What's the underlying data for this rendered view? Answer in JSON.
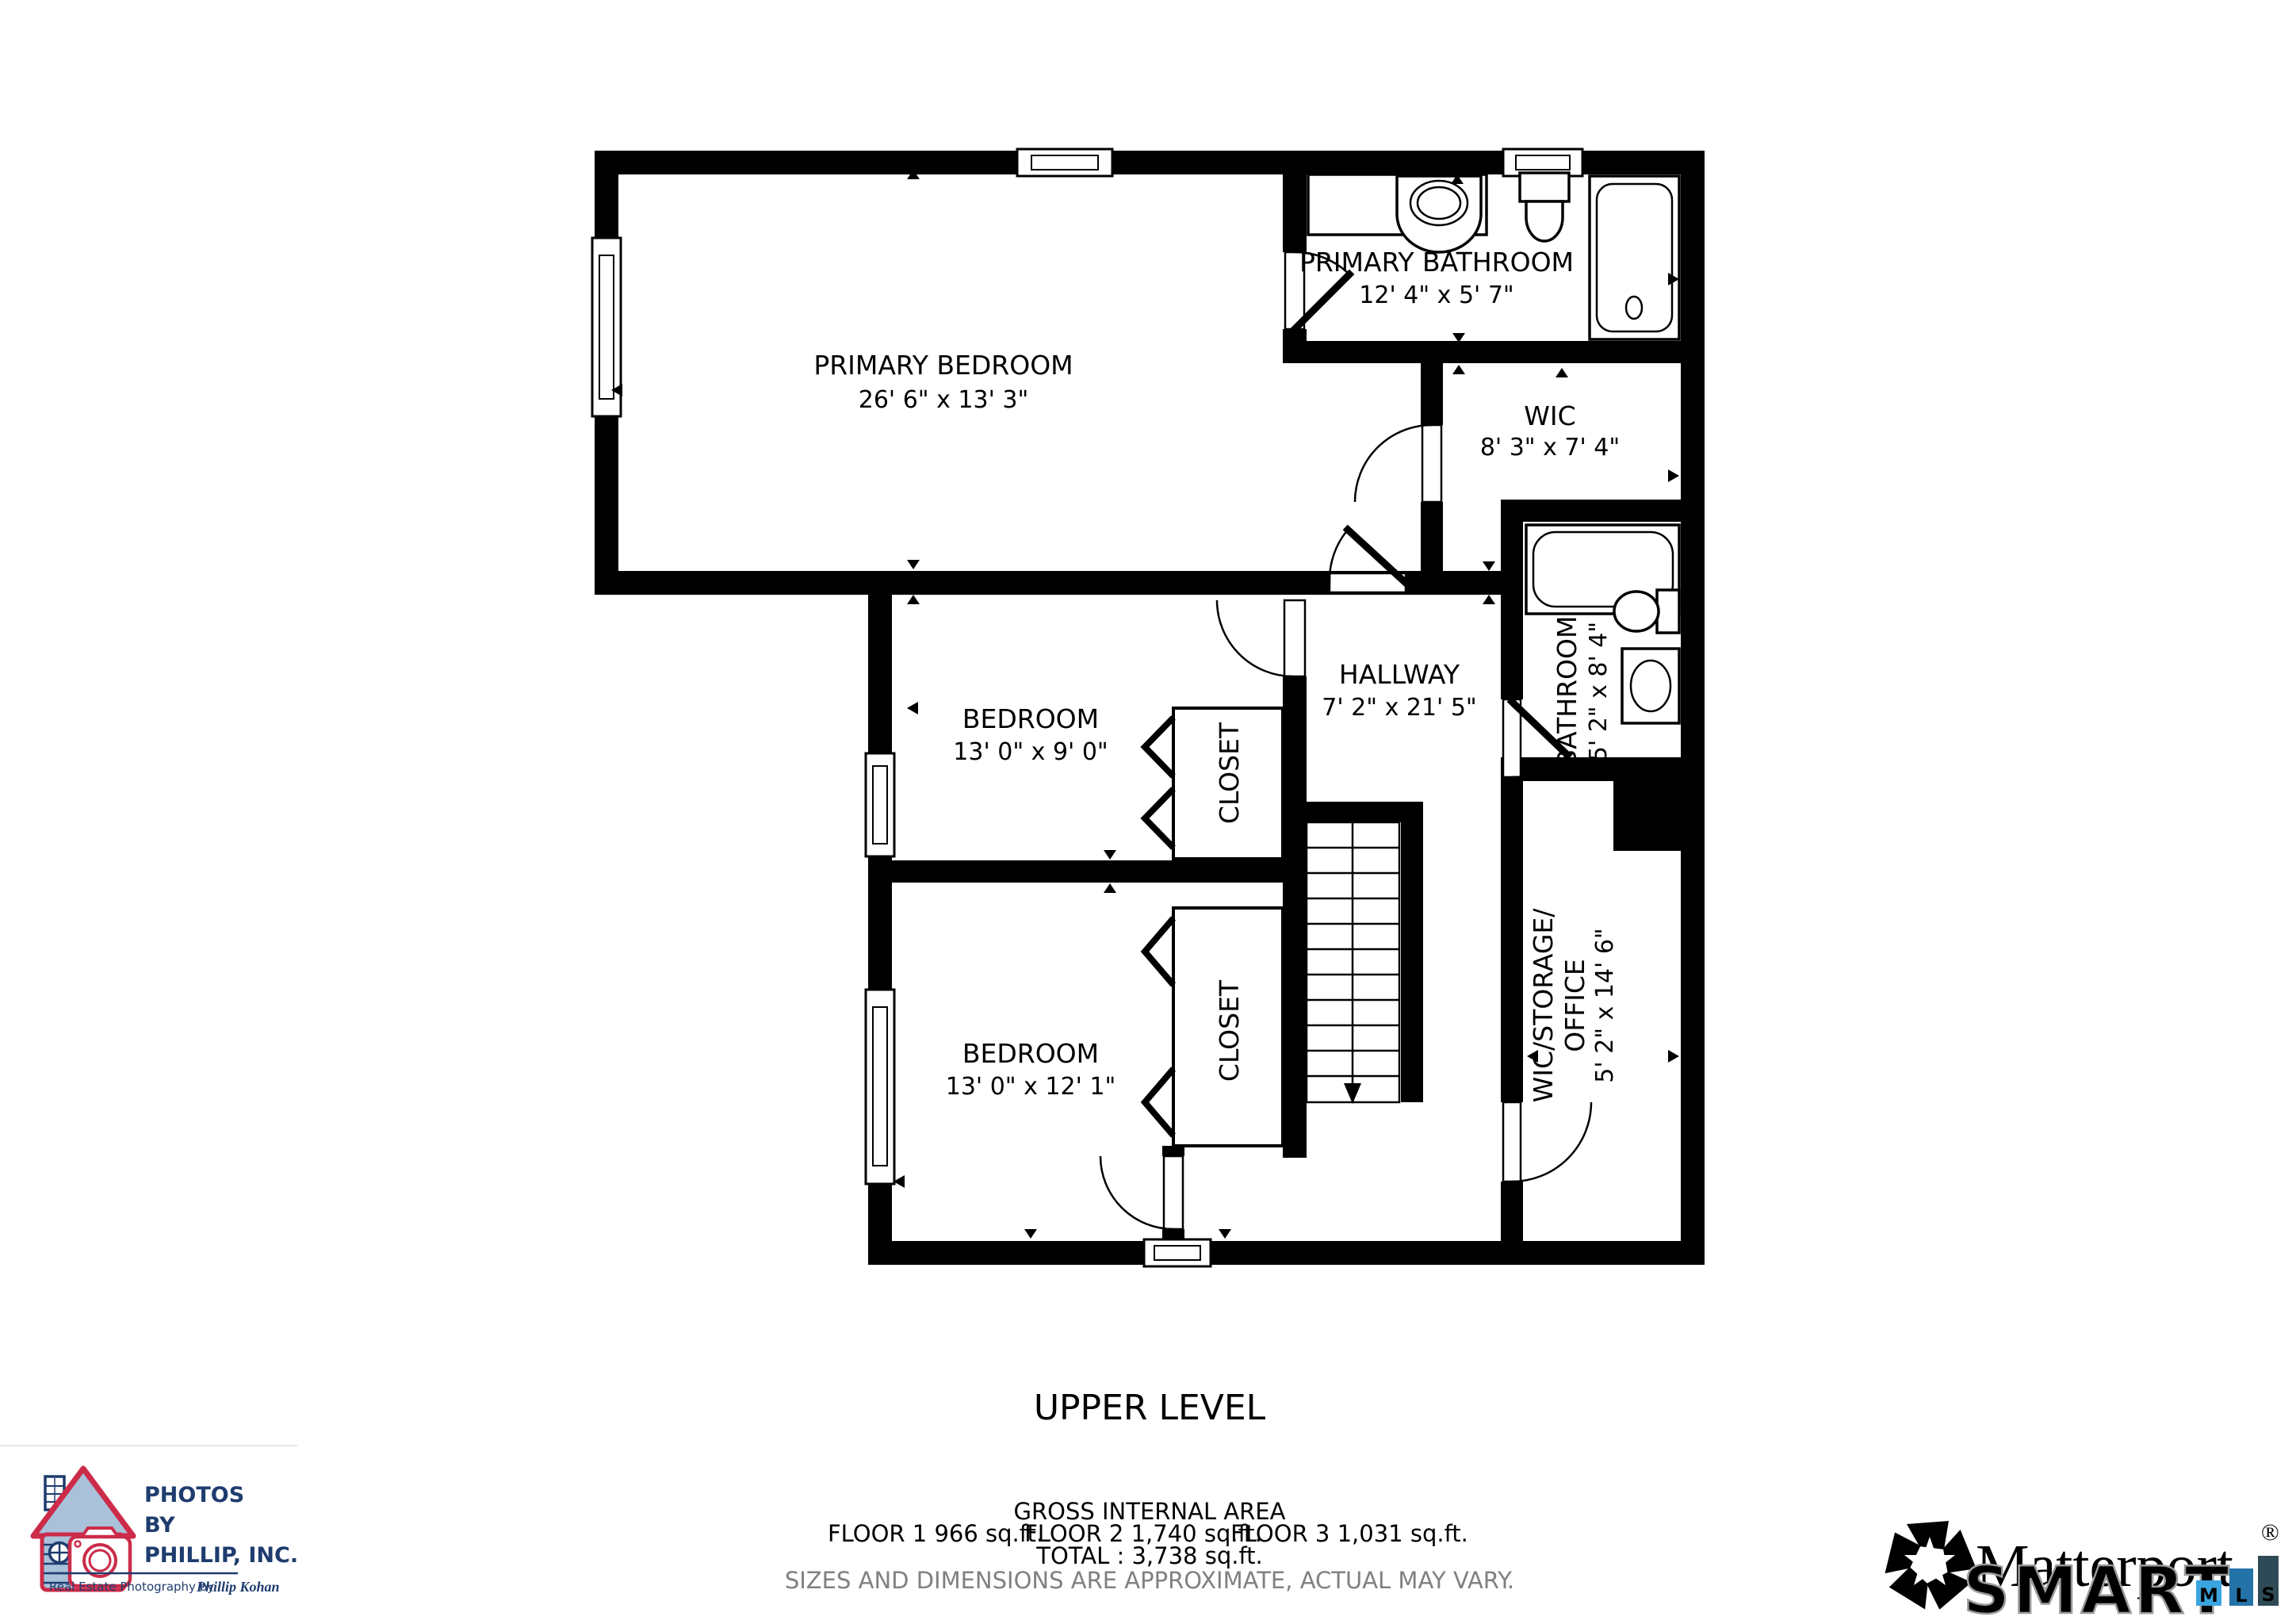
{
  "title": "UPPER LEVEL",
  "rooms": {
    "primary_bedroom": {
      "name": "PRIMARY BEDROOM",
      "dims": "26' 6\" x 13' 3\""
    },
    "primary_bathroom": {
      "name": "PRIMARY BATHROOM",
      "dims": "12' 4\" x 5' 7\""
    },
    "wic": {
      "name": "WIC",
      "dims": "8' 3\" x 7' 4\""
    },
    "hallway": {
      "name": "HALLWAY",
      "dims": "7' 2\" x 21' 5\""
    },
    "bedroom_top": {
      "name": "BEDROOM",
      "dims": "13' 0\" x 9' 0\""
    },
    "bedroom_bottom": {
      "name": "BEDROOM",
      "dims": "13' 0\" x 12' 1\""
    },
    "closet_top": {
      "name": "CLOSET"
    },
    "closet_bottom": {
      "name": "CLOSET"
    },
    "bathroom": {
      "name": "BATHROOM",
      "dims": "5' 2\" x 8' 4\""
    },
    "wic_storage_office": {
      "name_line1": "WIC/STORAGE/",
      "name_line2": "OFFICE",
      "dims": "5' 2\" x 14' 6\""
    }
  },
  "footer": {
    "gross_internal_area": "GROSS INTERNAL AREA",
    "floor1": "FLOOR 1 966 sq.ft.",
    "floor2": "FLOOR 2 1,740 sq.ft.",
    "floor3": "FLOOR 3 1,031 sq.ft.",
    "total": "TOTAL :  3,738 sq.ft.",
    "disclaimer": "SIZES AND DIMENSIONS ARE APPROXIMATE, ACTUAL MAY VARY."
  },
  "branding": {
    "photos_by_phillip": {
      "line1": "PHOTOS",
      "line2": "BY",
      "line3": "PHILLIP, INC.",
      "tagline_prefix": "Real Estate Photography by",
      "tagline_name": "Phillip Kohan"
    },
    "matterport": {
      "wordmark": "Matterport",
      "registered": "®"
    },
    "smart_mls": {
      "word": "SMART",
      "m": "M",
      "l": "L",
      "s": "S"
    }
  },
  "colors": {
    "wall": "#000000",
    "disclaimer_gray": "#808080",
    "logo_crimson": "#cc2b49",
    "logo_navy": "#1e3c6e",
    "logo_house_fill": "#a9c2da",
    "mls_m_blue": "#3aa5df",
    "mls_l_blue": "#2473a8",
    "mls_s_slate": "#2e4a57"
  }
}
